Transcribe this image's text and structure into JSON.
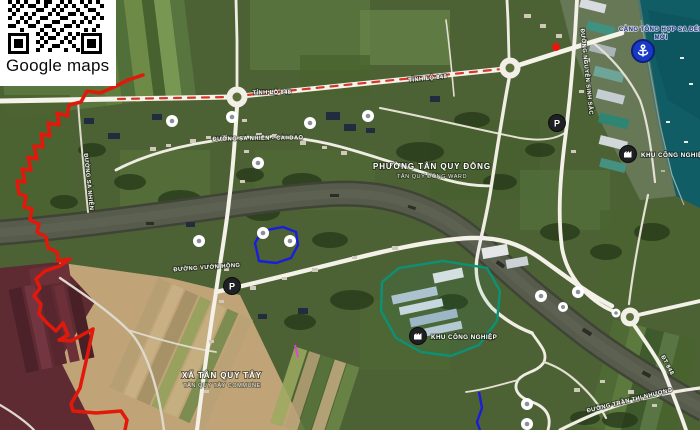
{
  "overlay": {
    "qr_label": "Google maps"
  },
  "map": {
    "labels": {
      "ward_title": "PHƯỜNG TÂN QUY ĐÔNG",
      "ward_subtitle": "TÂN QUY ĐÔNG WARD",
      "commune_title": "XÃ TÂN QUY TÂY",
      "commune_subtitle": "TÂN QUY TÂY COMMUNE",
      "port_line1": "CẢNG TỔNG HỢP SA ĐÉC",
      "port_line2": "MỚI",
      "industrial_north": "KHU CÔNG NGHIỆP",
      "industrial_south": "KHU CÔNG NGHIỆP",
      "parking_glyph": "P"
    },
    "road_labels": [
      {
        "text": "TỈNH LỘ 848"
      },
      {
        "text": "TỈNH LỘ 848"
      },
      {
        "text": "ĐƯỜNG SA NHIÊN - CAI DAO"
      },
      {
        "text": "ĐƯỜNG VƯỜN HỒNG"
      },
      {
        "text": "ĐƯỜNG NGUYỄN SINH SẮC"
      },
      {
        "text": "ĐƯỜNG TRẦN THỊ NHƯỢNG"
      },
      {
        "text": "ĐT 848"
      },
      {
        "text": "ĐƯỜNG SA NHIÊN"
      }
    ],
    "icons": {
      "qr-code": "QR code to open map link",
      "poi-dot-icon": "white point-of-interest dot",
      "parking-icon": "black circle with P",
      "factory-icon": "black circle with factory glyph",
      "anchor-icon": "blue circle port/anchor marker",
      "marker-dot-icon": "small red location dot",
      "roundabout-icon": "white roundabout ring"
    },
    "colors": {
      "boundary_red": "#e2180b",
      "plot_blue": "#1a1ddd",
      "zone_teal": "#0c9176",
      "route_dash_red": "#d6372b",
      "marker_red": "#e8170d",
      "port_icon_blue": "#1839c8",
      "water_teal": "#115d66",
      "river_gray": "#565b4b"
    }
  }
}
